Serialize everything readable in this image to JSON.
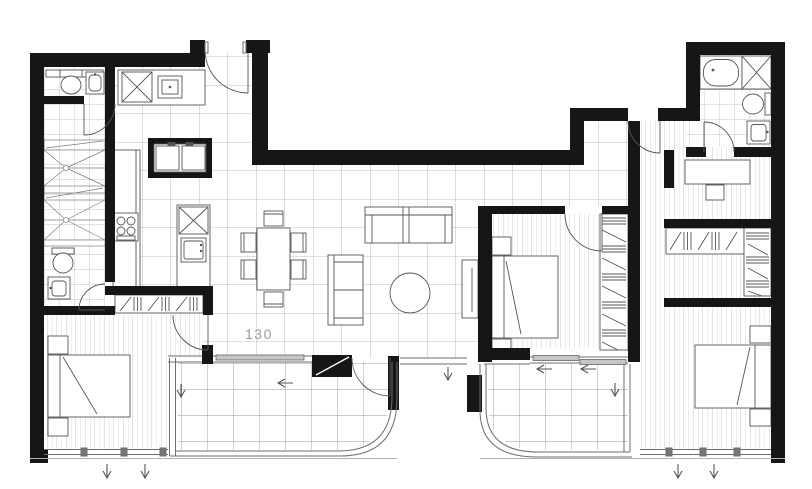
{
  "labels": {
    "area": "130"
  },
  "colors": {
    "background": "#ffffff",
    "wall": "#161616",
    "line": "#555555",
    "glass": "#6e6e6e",
    "grid_large": "#ababab",
    "grid_small": "#b4b4b4",
    "plank": "#bfbfbf",
    "balcony_grid": "#999999",
    "arrow": "#555555",
    "label": "#9a9a9a",
    "panel_gray": "#c6c6c6"
  },
  "legend": {
    "arrow_down_meaning": "opening direction",
    "arrow_left_meaning": "sliding direction"
  }
}
